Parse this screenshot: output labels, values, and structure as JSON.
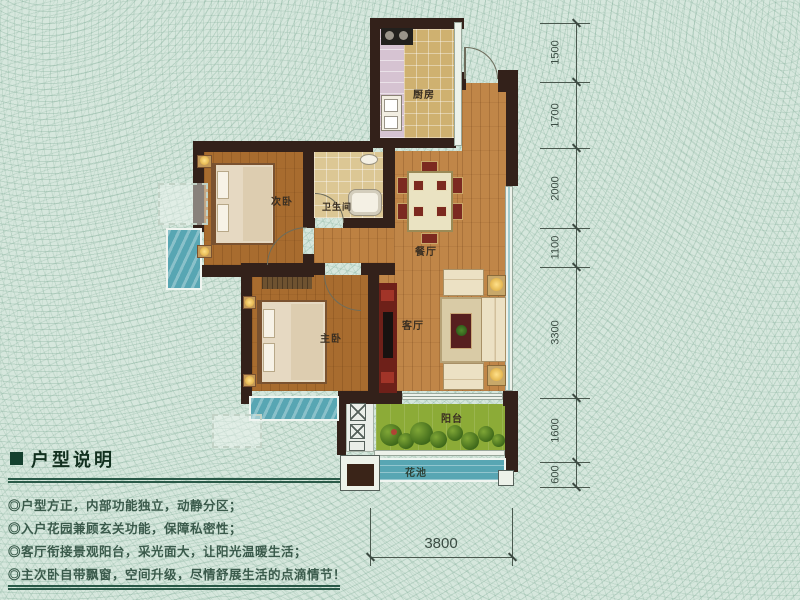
{
  "rooms": {
    "kitchen": "厨房",
    "secondary_bedroom": "次卧",
    "bathroom": "卫生间",
    "dining": "餐厅",
    "master_bedroom": "主卧",
    "living": "客厅",
    "balcony": "阳台",
    "flower_bed": "花池"
  },
  "dimensions": {
    "right": [
      "1500",
      "1700",
      "2000",
      "1100",
      "3300",
      "1600",
      "600"
    ],
    "bottom": "3800"
  },
  "description": {
    "title": "户型说明",
    "bullets": [
      "◎户型方正，内部功能独立，动静分区；",
      "◎入户花园兼顾玄关功能，保障私密性；",
      "◎客厅衔接景观阳台，采光面大，让阳光温暖生活；",
      "◎主次卧自带飘窗，空间升级，尽情舒展生活的点滴情节！"
    ]
  },
  "colors": {
    "background": "#d6e7dd",
    "wall": "#33211a",
    "wood_light": "#c08648",
    "wood_dark": "#a86c2f",
    "glass": "#58a6b3",
    "balcony_green": "#8cab37",
    "accent_green": "#2a5a48"
  }
}
